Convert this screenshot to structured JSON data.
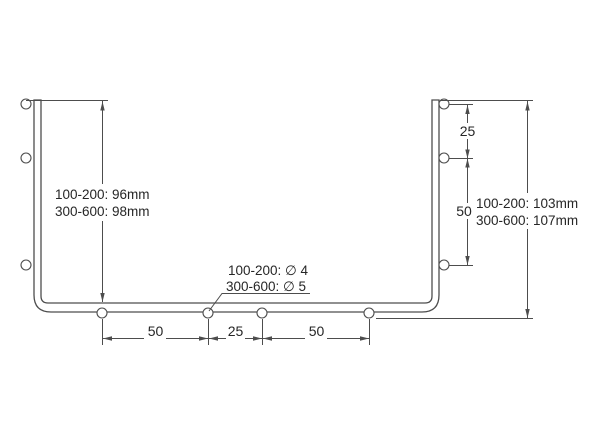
{
  "diagram": {
    "type": "technical-drawing-u-channel-side-profile",
    "left_height": {
      "line1": "100-200: 96mm",
      "line2": "300-600: 98mm"
    },
    "right_height": {
      "line1": "100-200: 103mm",
      "line2": "300-600: 107mm"
    },
    "hole_diameter": {
      "line1": "100-200: ∅ 4",
      "line2": "300-600: ∅ 5"
    },
    "right_hole_spacing": {
      "top": "25",
      "bottom": "50"
    },
    "bottom_hole_spacing": {
      "left": "50",
      "middle": "25",
      "right": "50"
    },
    "colors": {
      "line": "#4d4d4d",
      "text": "#262626",
      "background": "#ffffff"
    }
  }
}
